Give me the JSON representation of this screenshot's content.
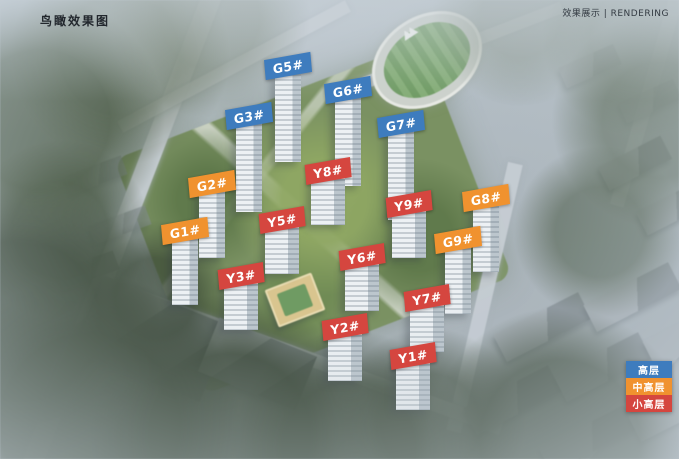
{
  "header": {
    "title": "鸟瞰效果图",
    "caption": "效果展示 | RENDERING"
  },
  "colors": {
    "high_rise": "#3e7cbe",
    "mid_high_rise": "#f0922f",
    "small_high_rise": "#d5463f"
  },
  "legend": {
    "items": [
      {
        "label": "高层",
        "type": "high_rise"
      },
      {
        "label": "中高层",
        "type": "mid_high_rise"
      },
      {
        "label": "小高层",
        "type": "small_high_rise"
      }
    ]
  },
  "buildings": [
    {
      "label": "G5#",
      "type": "high_rise",
      "x": 288,
      "y": 66
    },
    {
      "label": "G6#",
      "type": "high_rise",
      "x": 348,
      "y": 90
    },
    {
      "label": "G3#",
      "type": "high_rise",
      "x": 249,
      "y": 116
    },
    {
      "label": "G7#",
      "type": "high_rise",
      "x": 401,
      "y": 124
    },
    {
      "label": "Y8#",
      "type": "small_high_rise",
      "x": 328,
      "y": 171
    },
    {
      "label": "G2#",
      "type": "mid_high_rise",
      "x": 212,
      "y": 184
    },
    {
      "label": "G8#",
      "type": "mid_high_rise",
      "x": 486,
      "y": 198
    },
    {
      "label": "Y9#",
      "type": "small_high_rise",
      "x": 409,
      "y": 204
    },
    {
      "label": "Y5#",
      "type": "small_high_rise",
      "x": 282,
      "y": 220
    },
    {
      "label": "G1#",
      "type": "mid_high_rise",
      "x": 185,
      "y": 231
    },
    {
      "label": "G9#",
      "type": "mid_high_rise",
      "x": 458,
      "y": 240
    },
    {
      "label": "Y6#",
      "type": "small_high_rise",
      "x": 362,
      "y": 257
    },
    {
      "label": "Y3#",
      "type": "small_high_rise",
      "x": 241,
      "y": 276
    },
    {
      "label": "Y7#",
      "type": "small_high_rise",
      "x": 427,
      "y": 298
    },
    {
      "label": "Y2#",
      "type": "small_high_rise",
      "x": 345,
      "y": 327
    },
    {
      "label": "Y1#",
      "type": "small_high_rise",
      "x": 413,
      "y": 356
    }
  ]
}
